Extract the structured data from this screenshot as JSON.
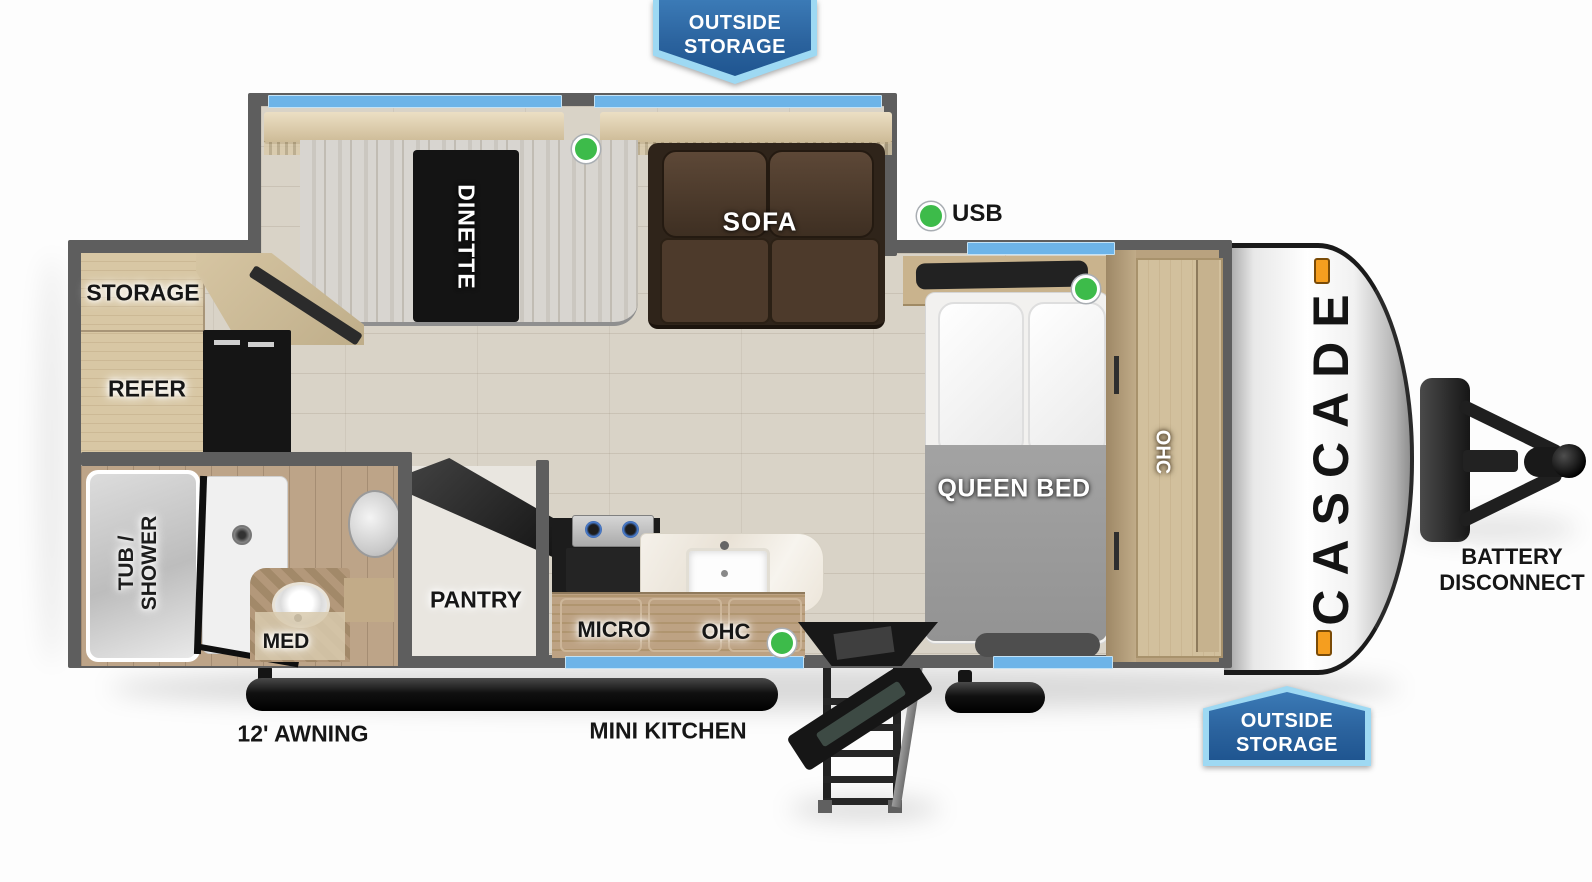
{
  "banners": {
    "top": {
      "line1": "OUTSIDE",
      "line2": "STORAGE"
    },
    "bottom_right": {
      "line1": "OUTSIDE",
      "line2": "STORAGE"
    }
  },
  "brand": {
    "name": "CASCADE"
  },
  "labels": {
    "dinette": "DINETTE",
    "sofa": "SOFA",
    "usb": "USB",
    "storage": "STORAGE",
    "refer": "REFER",
    "queen_bed": "QUEEN BED",
    "bedroom_ohc": "OHC",
    "tub_shower_line1": "TUB /",
    "tub_shower_line2": "SHOWER",
    "med": "MED",
    "pantry": "PANTRY",
    "micro": "MICRO",
    "kitchen_ohc": "OHC",
    "mini_kitchen": "MINI KITCHEN",
    "awning": "12' AWNING",
    "battery_line1": "BATTERY",
    "battery_line2": "DISCONNECT"
  },
  "indicators": {
    "led_dot_color": "#3dbb4a",
    "led_dot_count": 4
  },
  "colors": {
    "wall": "#5e5e5e",
    "window_blue": "#6db4e8",
    "banner_fill": "#2b639e",
    "banner_border": "#9ed9f3",
    "floor": "#d9d3c7",
    "sofa_brown": "#4d3a2b",
    "clearance_light_amber": "#f59e1f"
  }
}
